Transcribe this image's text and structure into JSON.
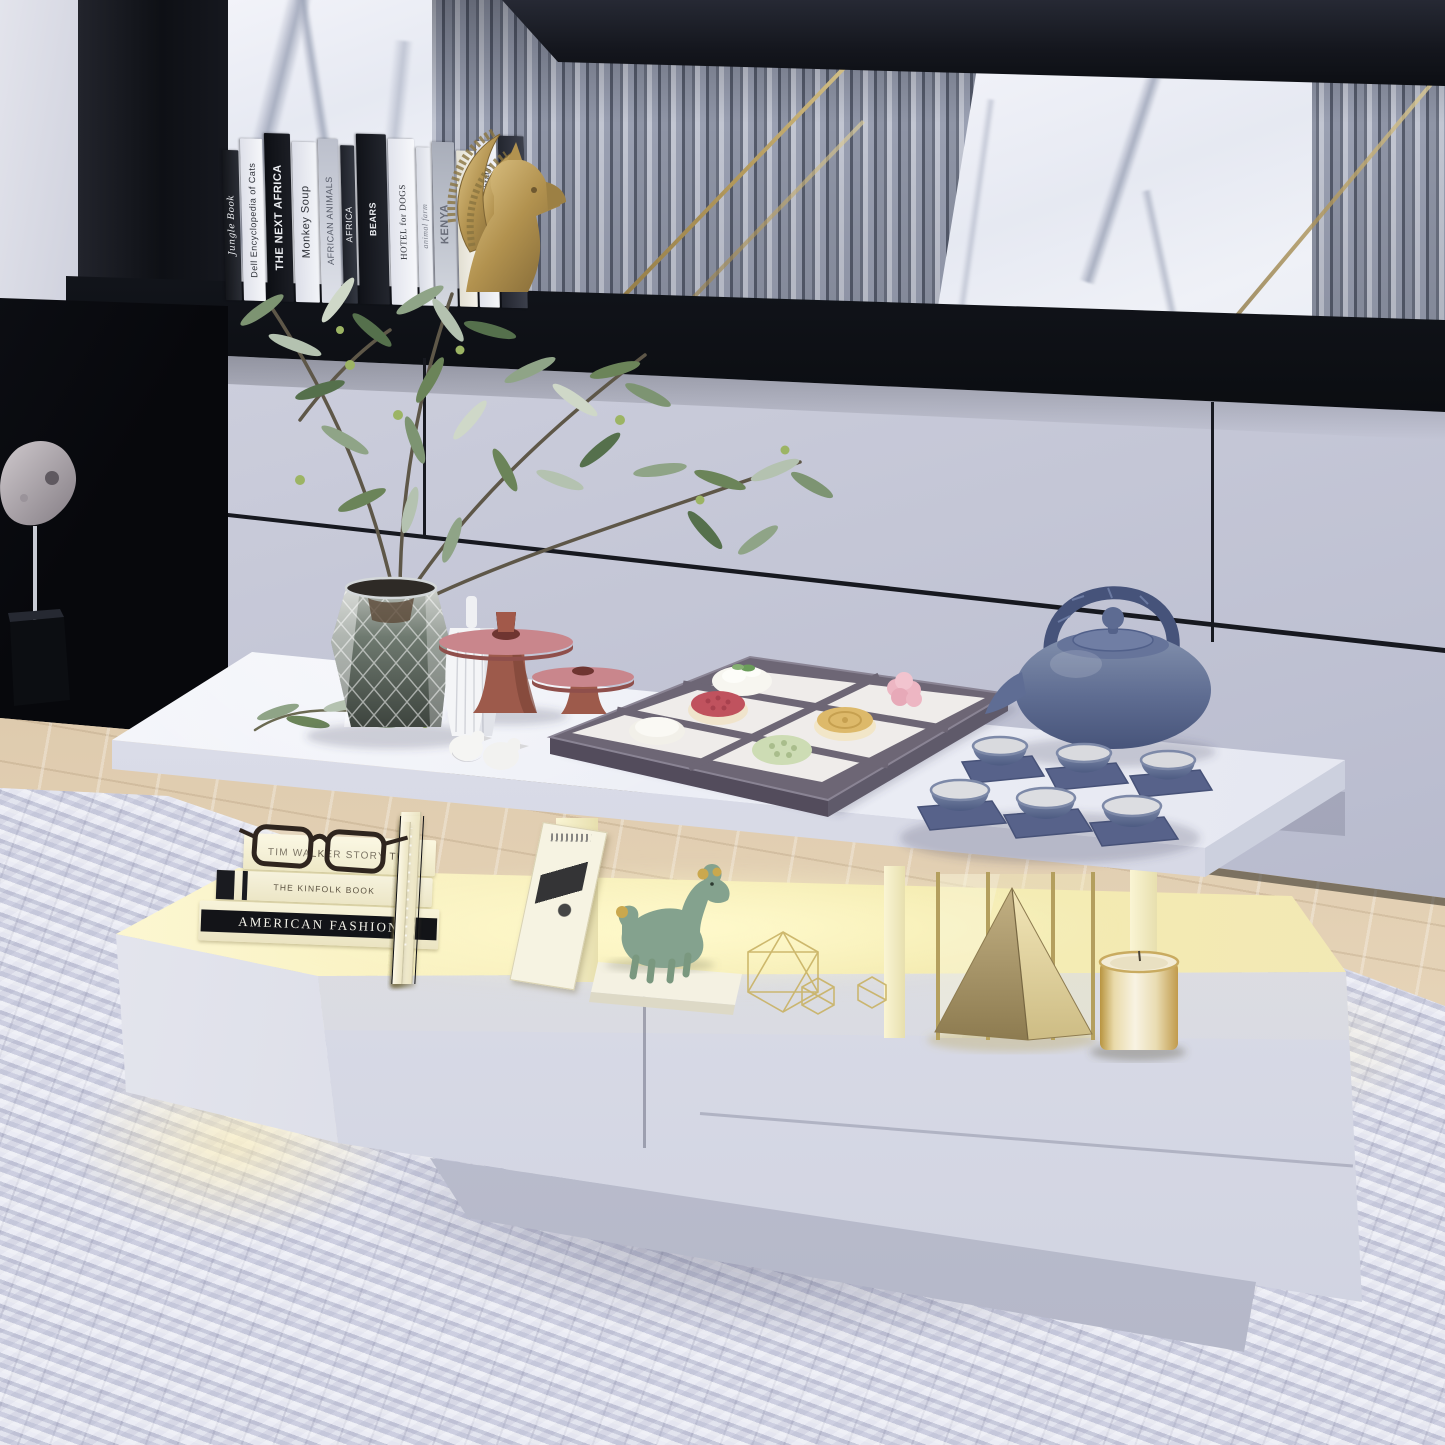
{
  "scene": {
    "type": "product lifestyle photograph",
    "subject": "Modern white LED coffee table with storage drawer and lighted open shelf",
    "setting": "Living room media wall with white cabinets, marble and fluted slat panels, black console shelf, white knit rug over light wood floor",
    "led_glow_color": "#f7eeb4"
  },
  "palette": {
    "cabinet_gray": "#c9cbd8",
    "black_panel": "#13151b",
    "marble_white": "#eef0f6",
    "slat_gray": "#9aa0b2",
    "gold_accent": "#c4ad6b",
    "table_white": "#f3f4f9",
    "teaware_blue": "#6b7a9e",
    "terracotta": "#a35c4d",
    "plant_green": "#6b8459",
    "carpet_white": "#d9dbe9",
    "wood_floor": "#d8c3a6"
  },
  "top_shelf": {
    "books": [
      {
        "title": "Jungle Book",
        "spine": "#16181d"
      },
      {
        "title": "Dell Encyclopedia of Cats",
        "spine": "#f2f3f6"
      },
      {
        "title": "THE NEXT AFRICA",
        "spine": "#101217"
      },
      {
        "title": "Monkey Soup",
        "spine": "#eef0f4"
      },
      {
        "title": "AFRICAN ANIMALS",
        "spine": "#d9dce4"
      },
      {
        "title": "AFRICA",
        "spine": "#2a2d35"
      },
      {
        "title": "BEARS",
        "spine": "#15171d"
      },
      {
        "title": "HOTEL for DOGS",
        "spine": "#f4f5f8"
      },
      {
        "title": "animal farm",
        "spine": "#e9ebf0"
      },
      {
        "title": "KENYA",
        "spine": "#ccd0d9"
      },
      {
        "title": "DOG",
        "spine": "#f1efe8"
      },
      {
        "title": "Jungle Animals (Little Library)",
        "spine": "#f3f4f7"
      },
      {
        "title": "WEREWORLD",
        "spine": "#343842"
      }
    ],
    "bookend": "gold gazelle sculpture with beaded horns"
  },
  "tabletop_items": [
    "faceted smoked-glass vase with olive branches",
    "white ribbed bottle vase",
    "two terracotta pedestal bud vases",
    "two white bird figurines",
    "gray wood sweets tray with six assorted mooncakes",
    "blue clay teapot with arch handle",
    "six blue tea bowls on slate coasters"
  ],
  "lower_shelf": {
    "stacked_books": [
      {
        "title": "TIM WALKER STORY TEL"
      },
      {
        "title": "THE KINFOLK BOOK"
      },
      {
        "title": "AMERICAN FASHION"
      }
    ],
    "items": [
      "black reading glasses",
      "standing white art books and magazine",
      "sage green deer figurine on white book",
      "gold wire polyhedra",
      "gold pyramid between gold-framed glass panels",
      "gold glass candle"
    ]
  },
  "left_alcove": "abstract stone sculpture on metal stem with black cube base"
}
